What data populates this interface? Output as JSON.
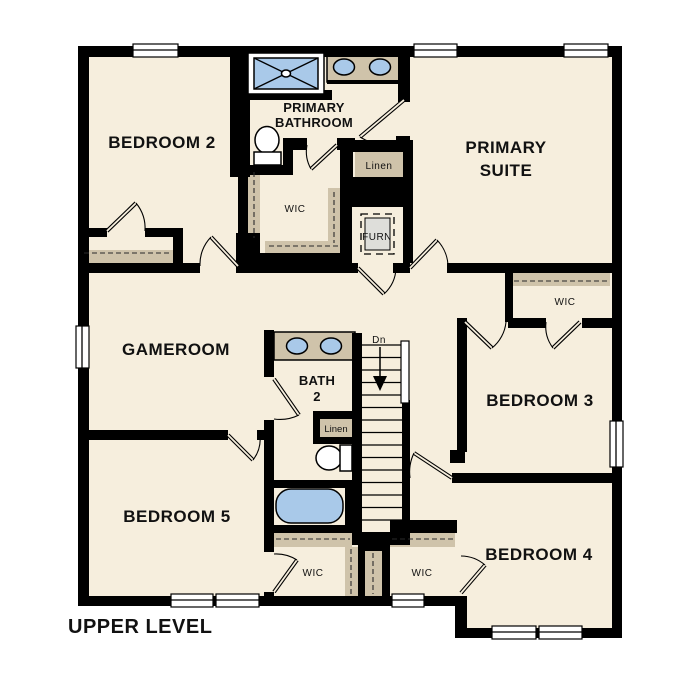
{
  "title": "UPPER LEVEL",
  "colors": {
    "wall": "#000000",
    "floor": "#f6eedd",
    "closet": "#cfc3aa",
    "fixture": "#a9c9e9",
    "appliance": "#dededa"
  },
  "rooms": {
    "bedroom2": "BEDROOM 2",
    "primary_bathroom_1": "PRIMARY",
    "primary_bathroom_2": "BATHROOM",
    "primary_suite_1": "PRIMARY",
    "primary_suite_2": "SUITE",
    "gameroom": "GAMEROOM",
    "bath2_1": "BATH",
    "bath2_2": "2",
    "bedroom3": "BEDROOM 3",
    "bedroom4": "BEDROOM 4",
    "bedroom5": "BEDROOM 5"
  },
  "closets": {
    "primary_wic": "WIC",
    "bedroom3_wic": "WIC",
    "bedroom5_wic": "WIC",
    "bedroom4_wic": "WIC",
    "linen_primary": "Linen",
    "linen_bath2": "Linen",
    "furnace": "FURN"
  },
  "stairs": {
    "down_label": "Dn"
  }
}
